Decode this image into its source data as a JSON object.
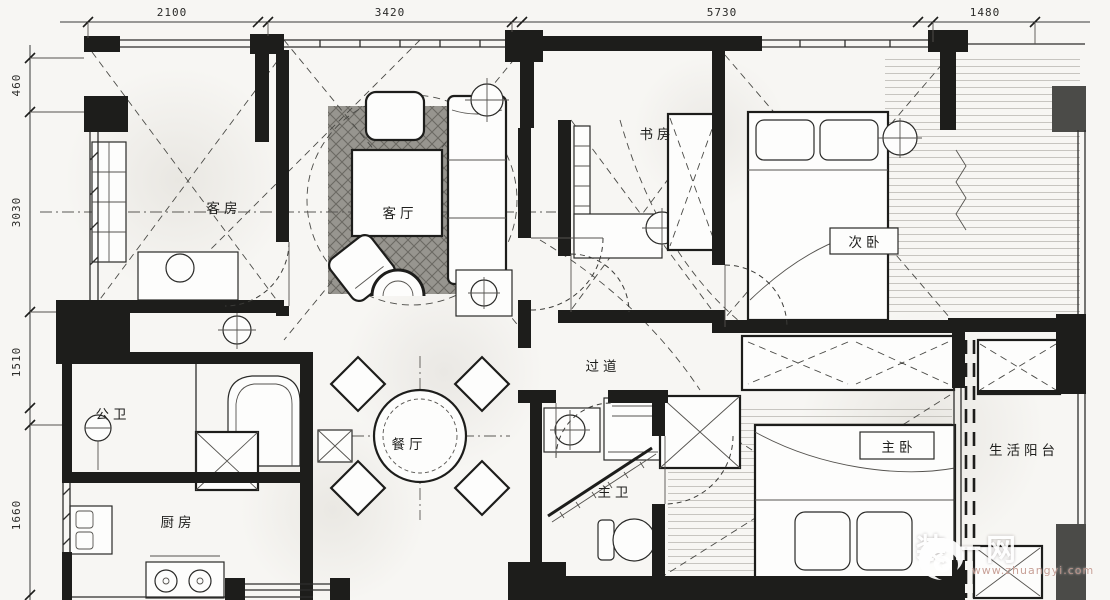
{
  "plan": {
    "rooms": {
      "guest": {
        "label": "客房"
      },
      "living": {
        "label": "客厅"
      },
      "study": {
        "label": "书房"
      },
      "bedroom2": {
        "label": "次卧"
      },
      "corridor": {
        "label": "过道"
      },
      "public_bath": {
        "label": "公卫"
      },
      "dining": {
        "label": "餐厅"
      },
      "master_bath": {
        "label": "主卫"
      },
      "master": {
        "label": "主卧"
      },
      "balcony": {
        "label": "生活阳台"
      },
      "kitchen": {
        "label": "厨房"
      }
    },
    "dimensions": {
      "top": [
        "2100",
        "3420",
        "5730",
        "1480"
      ],
      "left": [
        "460",
        "3030",
        "1510",
        "1660"
      ]
    }
  },
  "watermark": {
    "brand": "装一网",
    "website": "www.zhuangyi.com"
  },
  "colors": {
    "wall": "#1d1d1b",
    "wall_gray": "#4b4b48",
    "background": "#f7f6f3",
    "rug": "#97958f",
    "watermark_brand": "#ffffff",
    "watermark_url": "#c49a90"
  }
}
